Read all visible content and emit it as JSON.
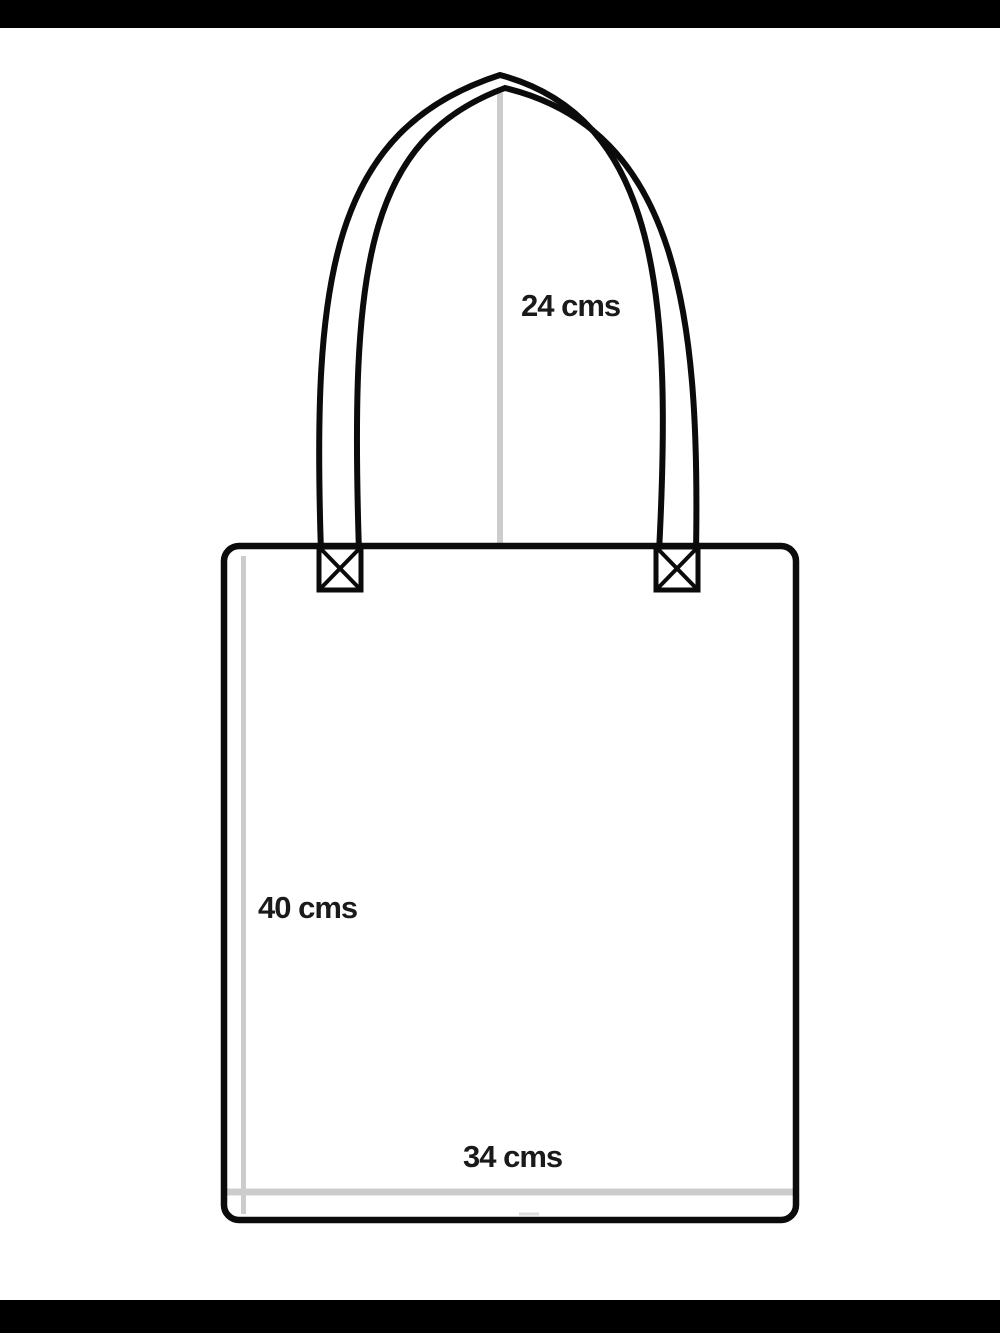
{
  "diagram": {
    "labels": {
      "handle_height": "24 cms",
      "bag_height": "40 cms",
      "bag_width": "34 cms"
    },
    "measurements_cm": {
      "handle_height": 24,
      "bag_height": 40,
      "bag_width": 34
    },
    "colors": {
      "outline": "#0b0b0b",
      "guide_line": "#cccccc",
      "guide_dash": "#dddddd",
      "label_text": "#1a1a1a",
      "background": "#ffffff",
      "letterbox": "#000000"
    }
  }
}
